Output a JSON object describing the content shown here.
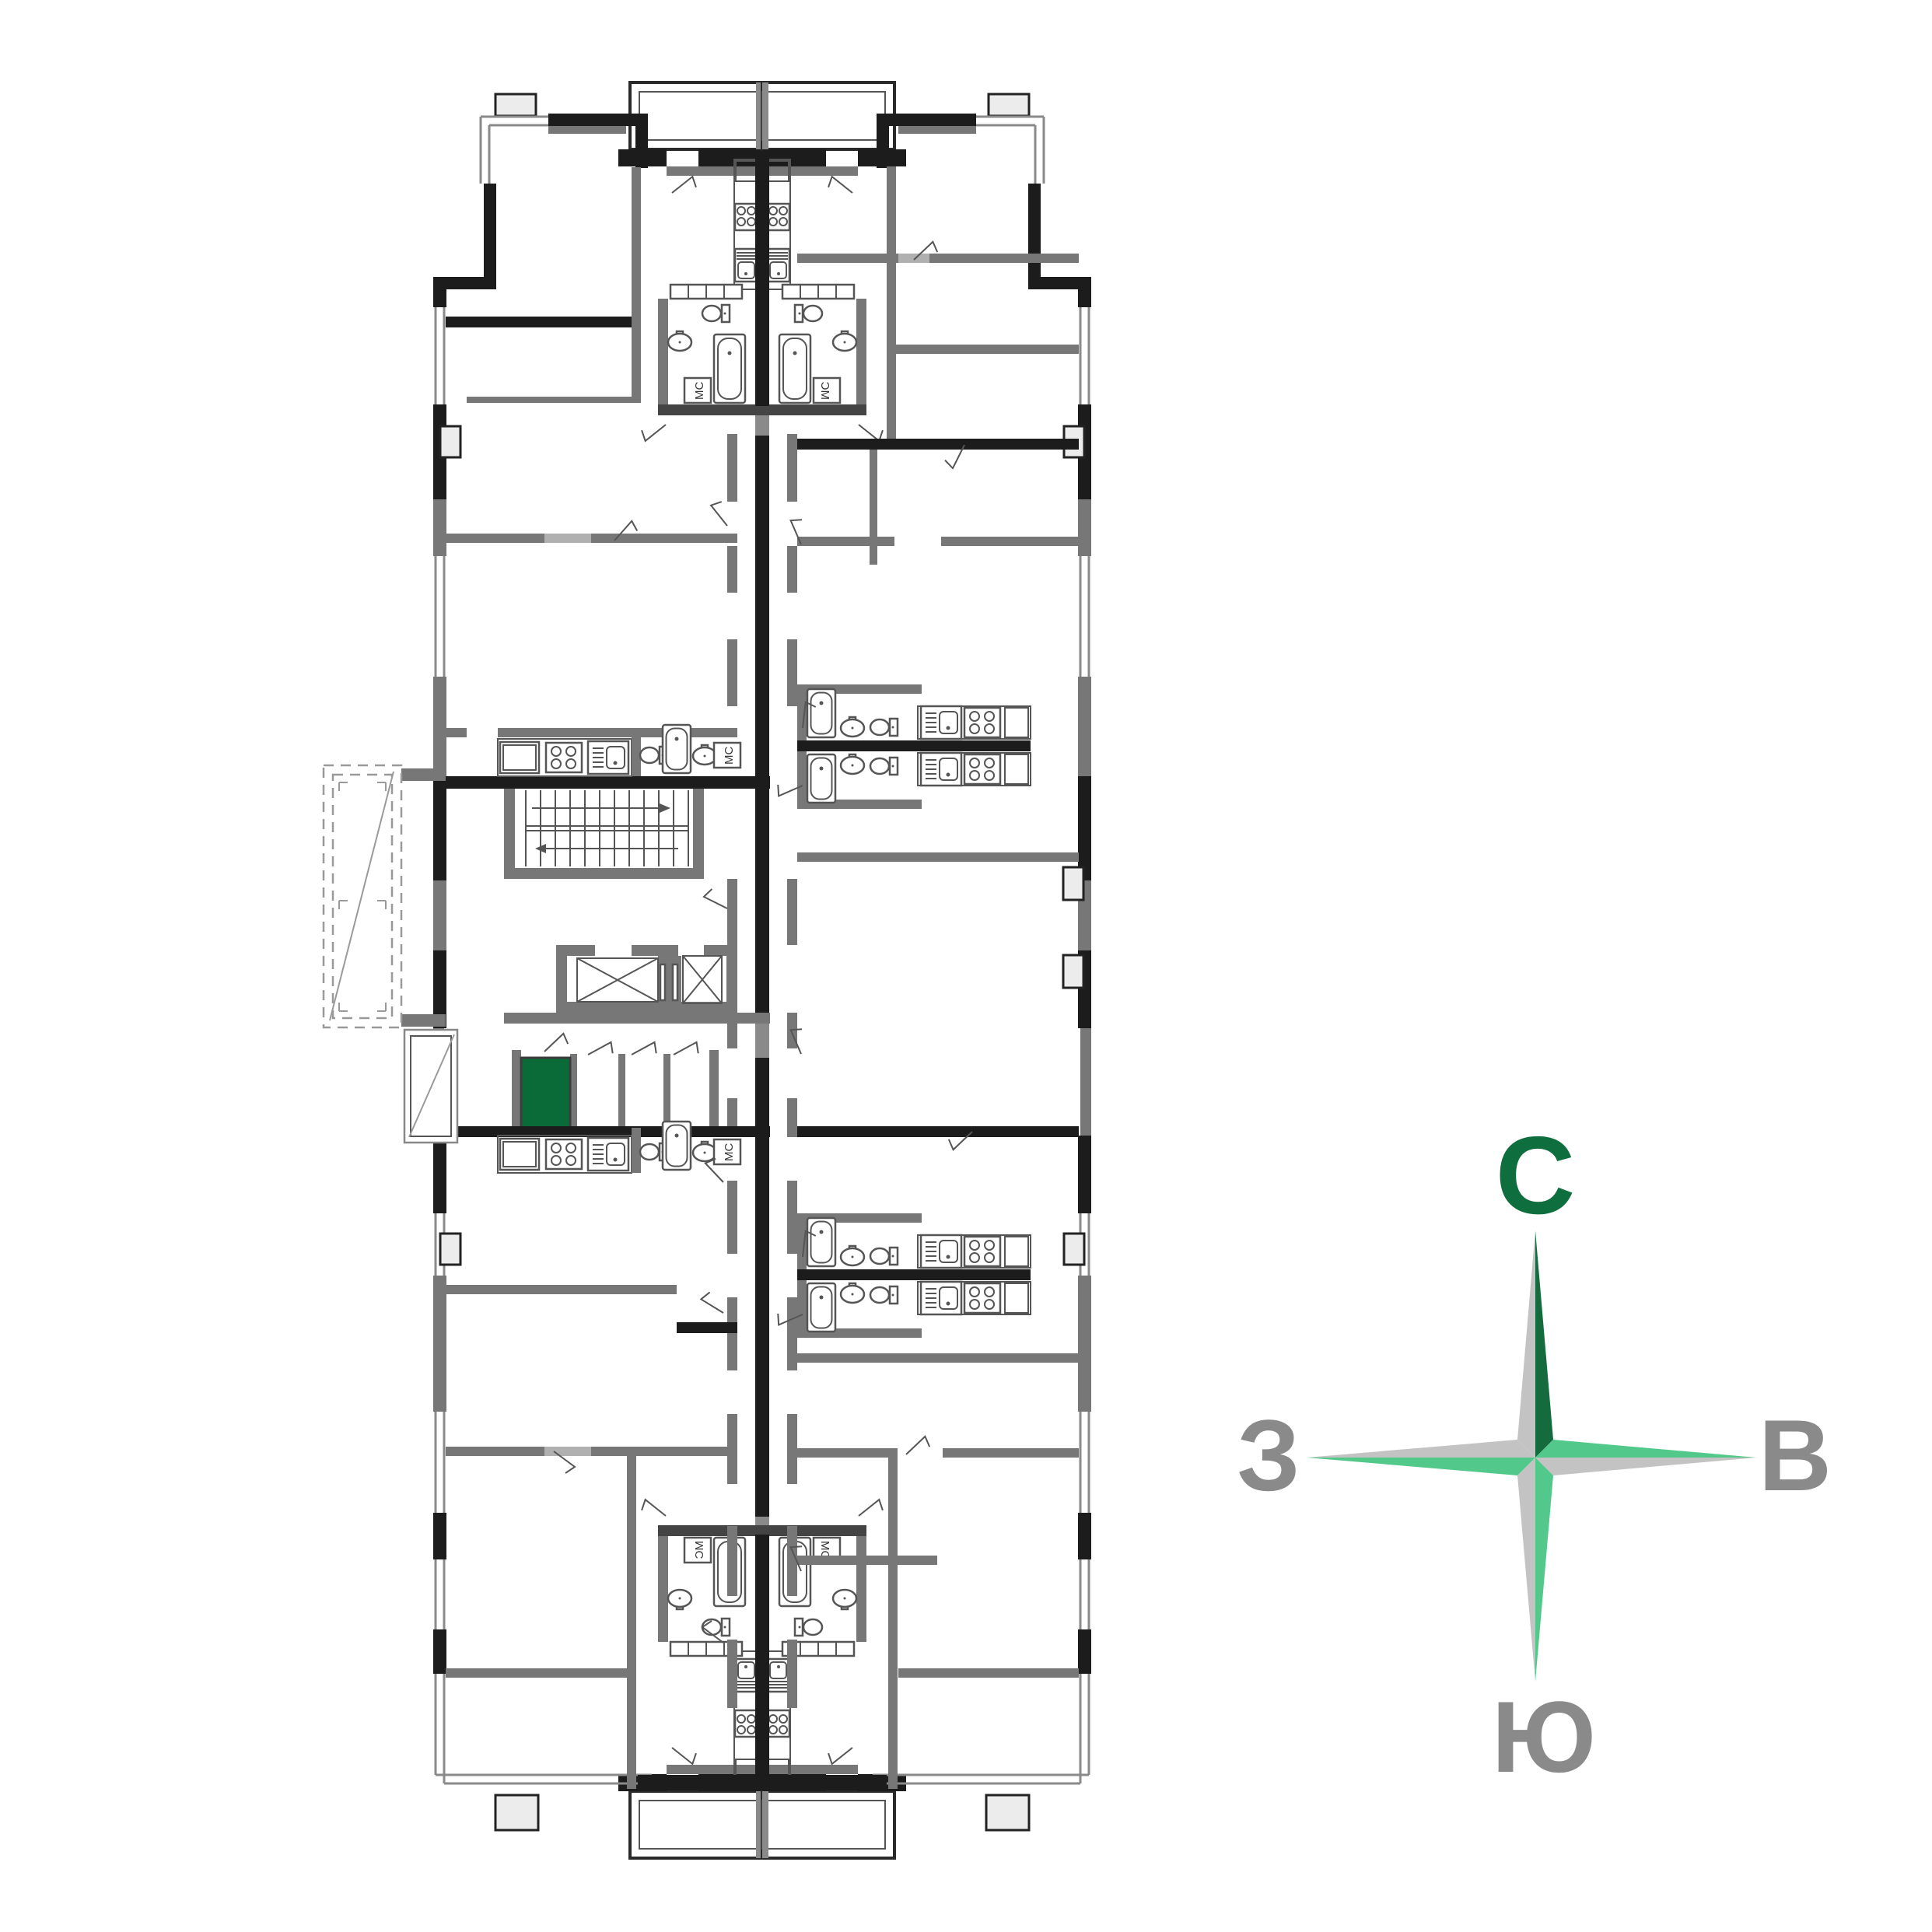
{
  "page": {
    "background": "#ffffff",
    "kind": "residential floor plan with selected unit highlight"
  },
  "colors": {
    "highlight_green": "#0a6b38",
    "compass_dark_green": "#156b3e",
    "compass_light_green": "#52c98b",
    "compass_silver": "#c3c3c3",
    "compass_label_green": "#0e6e3e",
    "compass_label_gray": "#8a8a8a",
    "wall_black": "#1c1c1c",
    "wall_gray": "#777777",
    "wall_light": "#b0b0b0",
    "fixture_stroke": "#555555"
  },
  "floor_plan": {
    "labels": {
      "washing_machine": "МС"
    },
    "highlighted_unit": {
      "highlighted": true,
      "fill": "#0a6b38"
    }
  },
  "compass": {
    "north_label": "С",
    "east_label": "В",
    "south_label": "Ю",
    "west_label": "З"
  }
}
